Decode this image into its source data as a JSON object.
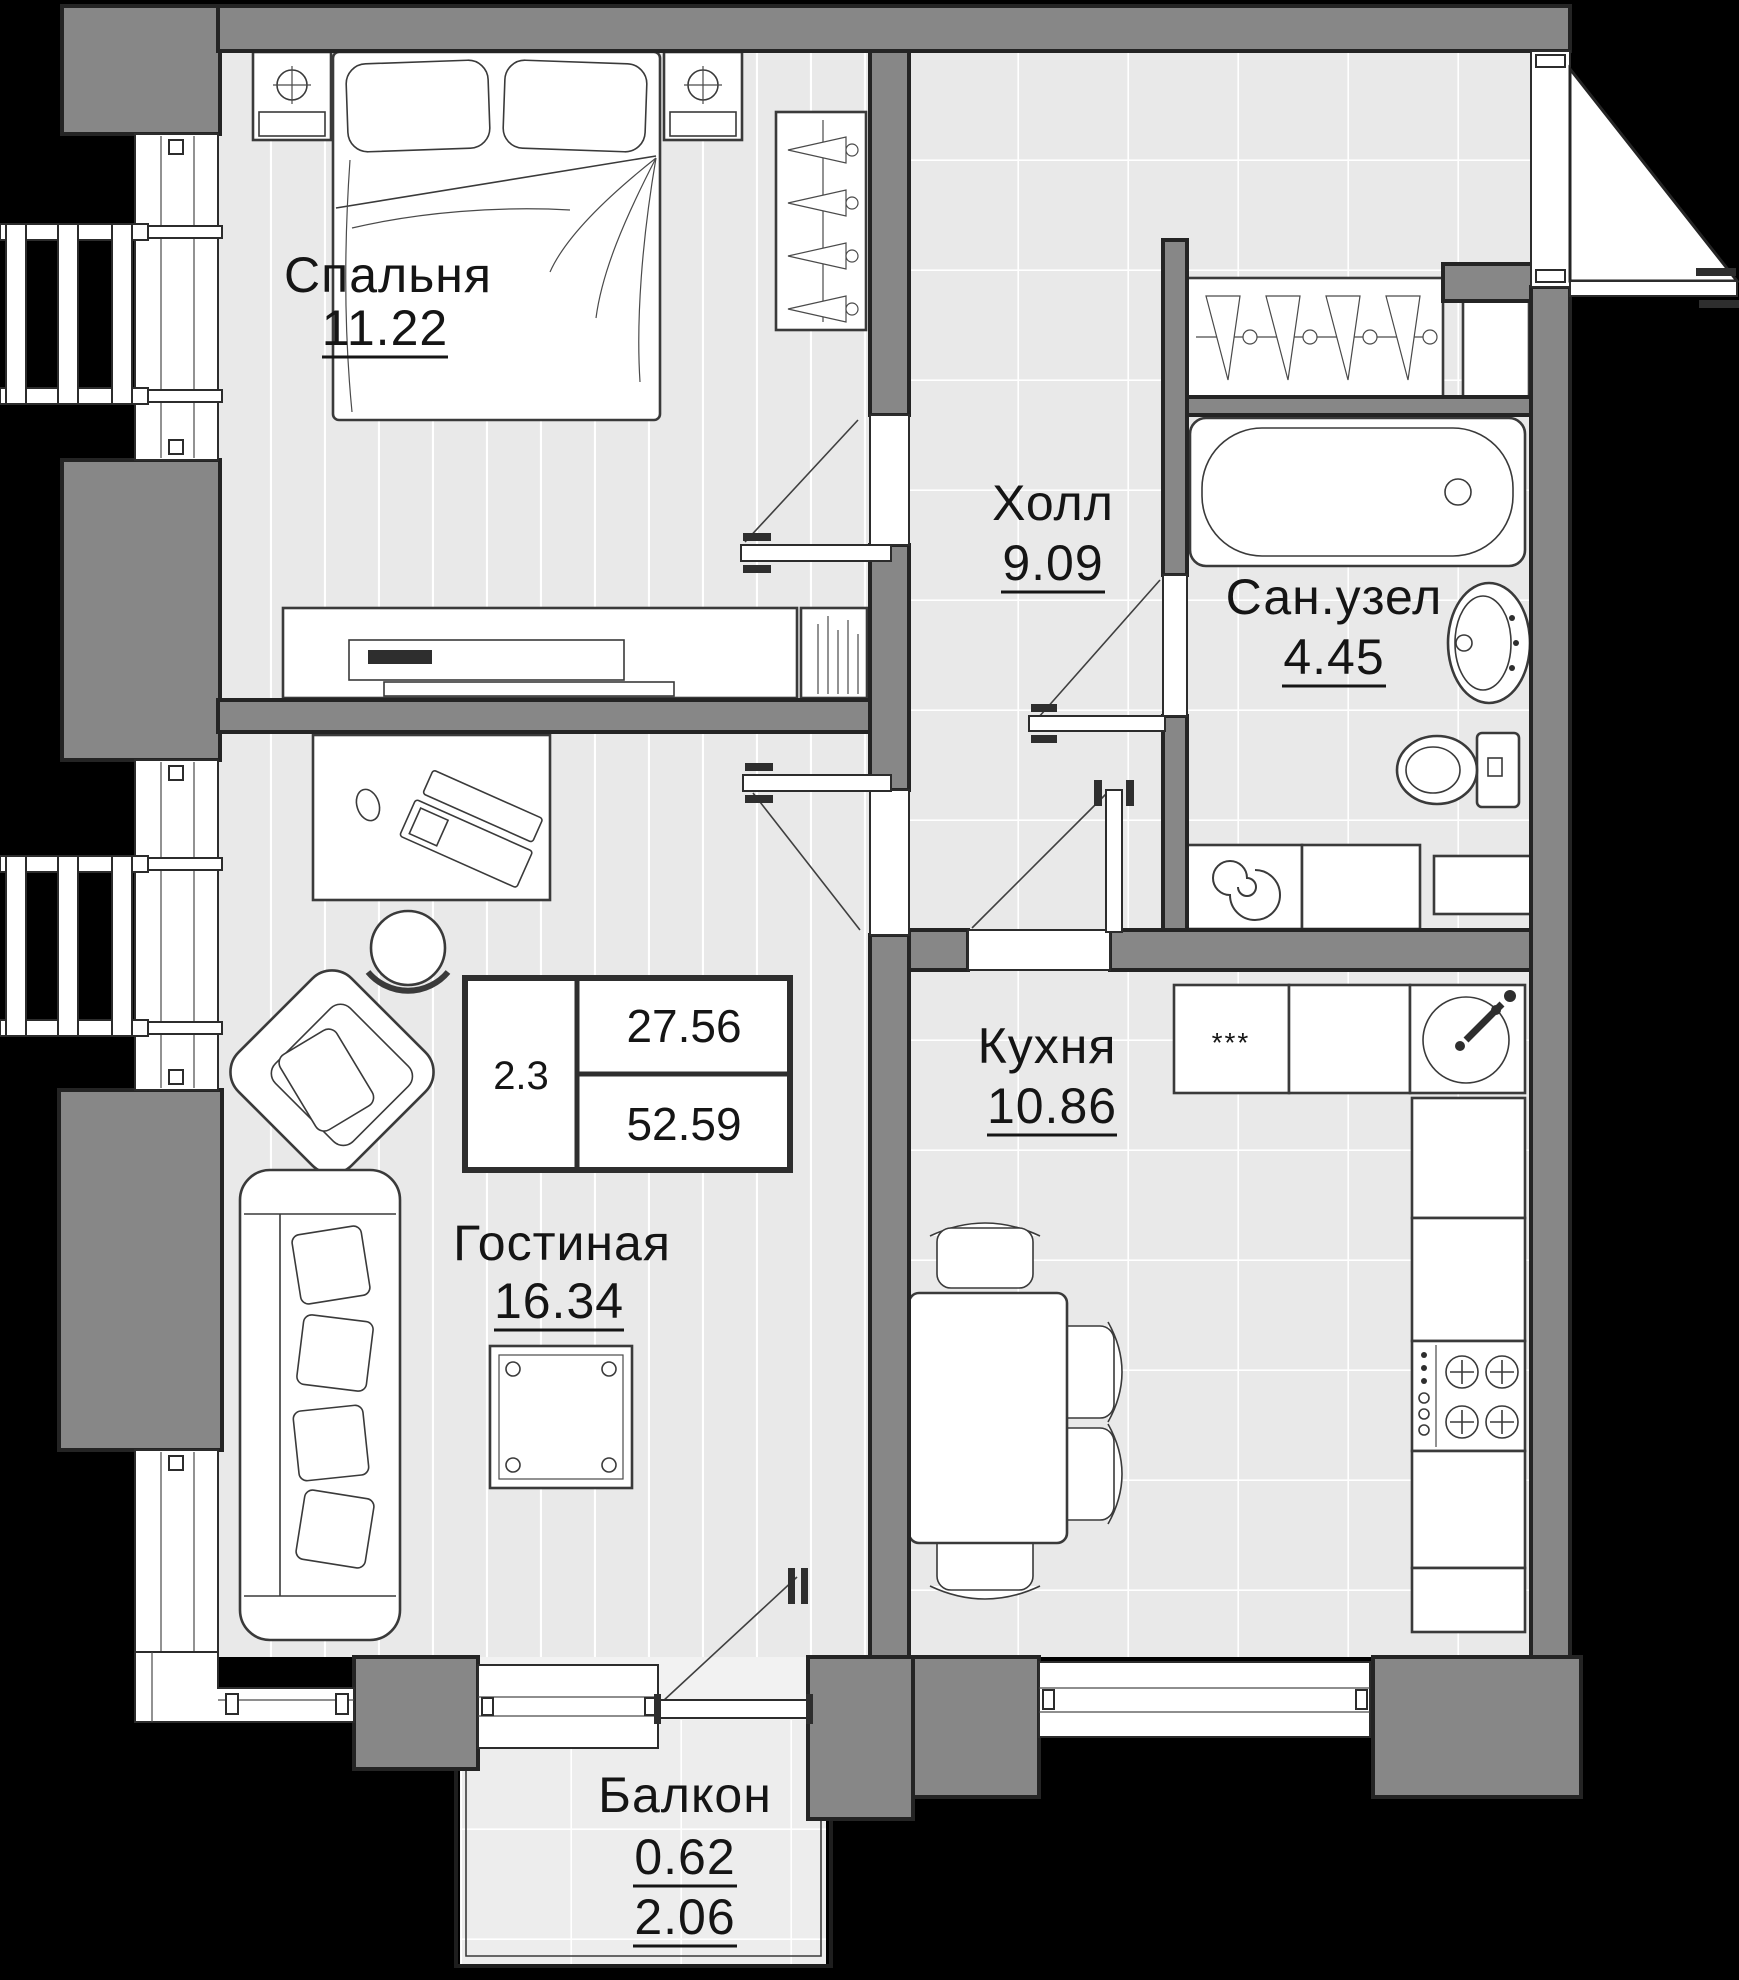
{
  "plan": {
    "type": "apartment-floor-plan",
    "rooms": [
      {
        "id": "bedroom",
        "name": "Спальня",
        "area": "11.22"
      },
      {
        "id": "hall",
        "name": "Холл",
        "area": "9.09"
      },
      {
        "id": "bathroom",
        "name": "Сан.узел",
        "area": "4.45"
      },
      {
        "id": "kitchen",
        "name": "Кухня",
        "area": "10.86"
      },
      {
        "id": "living",
        "name": "Гостиная",
        "area": "16.34"
      },
      {
        "id": "balcony",
        "name": "Балкон",
        "area_coefficient": "0.62",
        "area": "2.06"
      }
    ],
    "stamp": {
      "rooms_floor": "2.3",
      "living_area": "27.56",
      "total_area": "52.59"
    },
    "fridge_symbol": "***",
    "colors": {
      "background": "#000000",
      "wall": "#878787",
      "floor": "#e9e9e9",
      "floor_balcony": "#ededed",
      "fixture_fill": "#ffffff",
      "line": "#3a3a3a",
      "text": "#151515"
    }
  }
}
